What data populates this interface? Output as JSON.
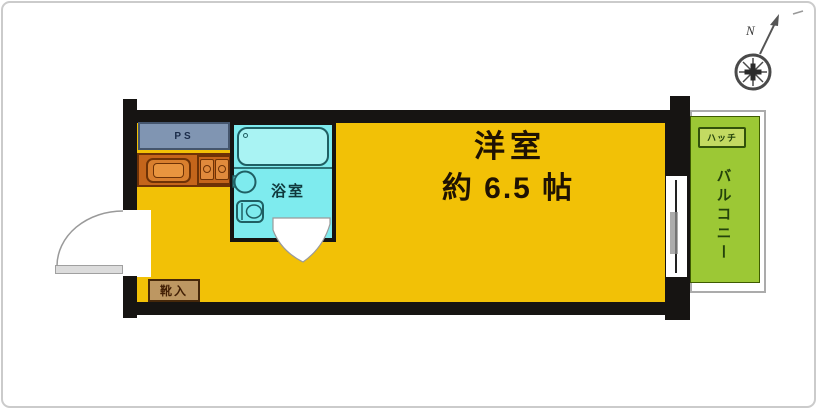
{
  "labels": {
    "room": "洋室",
    "room_size": "約 6.5 帖",
    "bathroom": "浴室",
    "balcony": "バルコニー",
    "hatch": "ハッチ",
    "pipe_space": "PS",
    "shoe_box": "靴入",
    "north": "N"
  },
  "colors": {
    "room_fill": "#F2C106",
    "balcony_fill": "#9CC835",
    "bathroom_fill": "#7EEBEE",
    "kitchen_fill": "#C4651B",
    "pipe_space_fill": "#8095B2",
    "shoe_box_fill": "#BD9762",
    "wall": "#161412"
  }
}
